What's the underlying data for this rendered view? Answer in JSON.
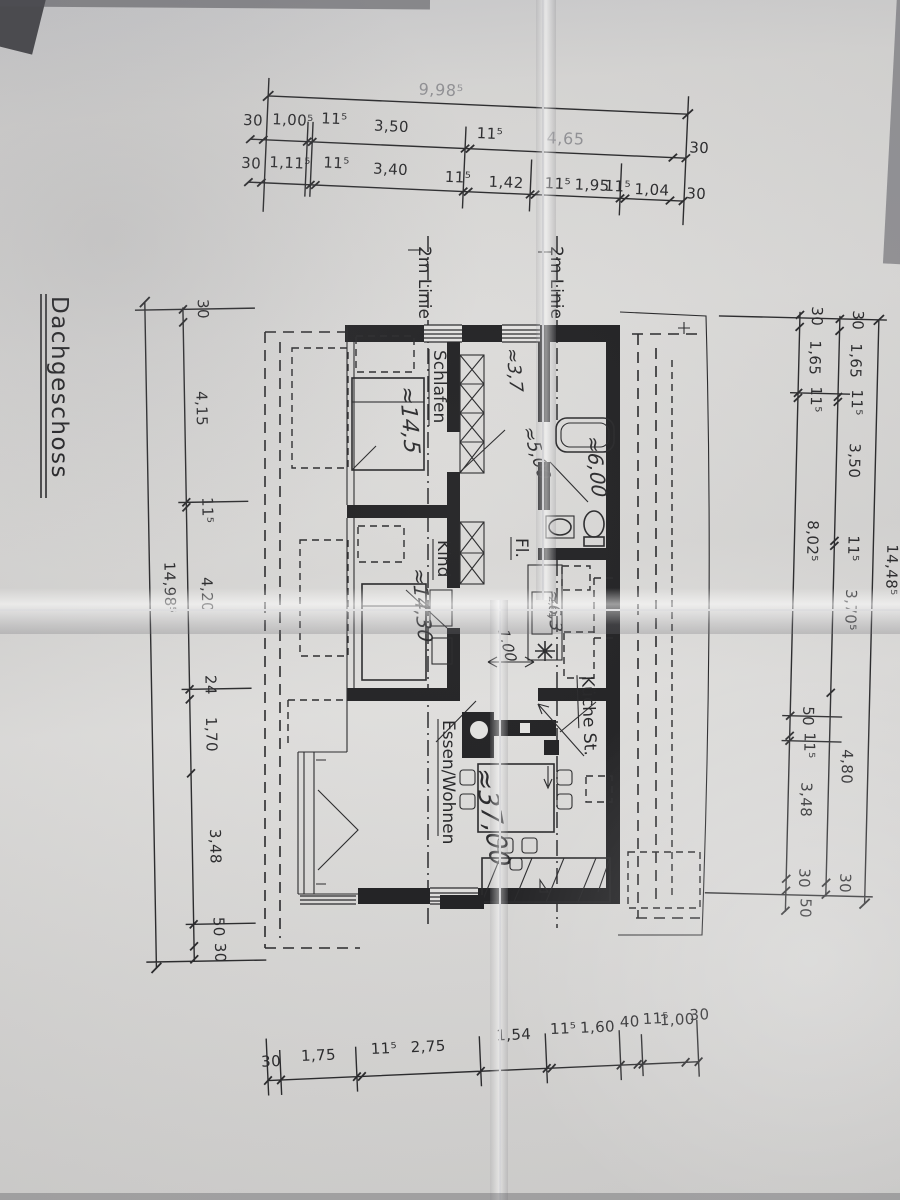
{
  "plan": {
    "title": "Dachgeschoss",
    "lines2m": {
      "left": "2m Linie",
      "right": "2m Linie"
    },
    "rooms": {
      "schlafen": {
        "name": "Schlafen",
        "area": "≈14,5"
      },
      "kind": {
        "name": "Kind",
        "area": "≈14,30"
      },
      "flur": {
        "name": "Fl.",
        "width": "≈3,7",
        "depth": "≈5,00"
      },
      "bad": {
        "area": "≈6,00"
      },
      "kueche": {
        "name": "Küche St.",
        "area": "≈6,3",
        "shaft_note": "2,61"
      },
      "wohnen": {
        "name": "Essen/Wohnen",
        "area": "≈37,00"
      },
      "passage": "1,00"
    }
  },
  "dims": {
    "top_overall": "9,98⁵",
    "top_row1": [
      "30",
      "1,00⁵",
      "11⁵",
      "3,50",
      "11⁵",
      "4,65",
      "30"
    ],
    "top_row2": [
      "30",
      "1,11⁵",
      "11⁵",
      "3,40",
      "11⁵",
      "1,42",
      "11⁵",
      "1,95",
      "11⁵",
      "1,04",
      "30"
    ],
    "left_overall": "14,98⁵",
    "left_chain": [
      "30",
      "4,15",
      "11⁵",
      "4,20",
      "24",
      "1,70",
      "3,48",
      "50",
      "30"
    ],
    "right_overall": "14,48⁵",
    "right_inner": [
      "30",
      "1,65",
      "11⁵",
      "8,02⁵",
      "50",
      "11⁵",
      "3,48",
      "30",
      "50"
    ],
    "right_middle": [
      "30",
      "1,65",
      "11⁵",
      "3,50",
      "11⁵",
      "3,70⁵",
      "4,80",
      "30"
    ],
    "bottom_row": [
      "30",
      "1,75",
      "11⁵",
      "2,75",
      "1,54",
      "11⁵",
      "1,60",
      "40",
      "11⁵",
      "1,00",
      "30"
    ]
  }
}
